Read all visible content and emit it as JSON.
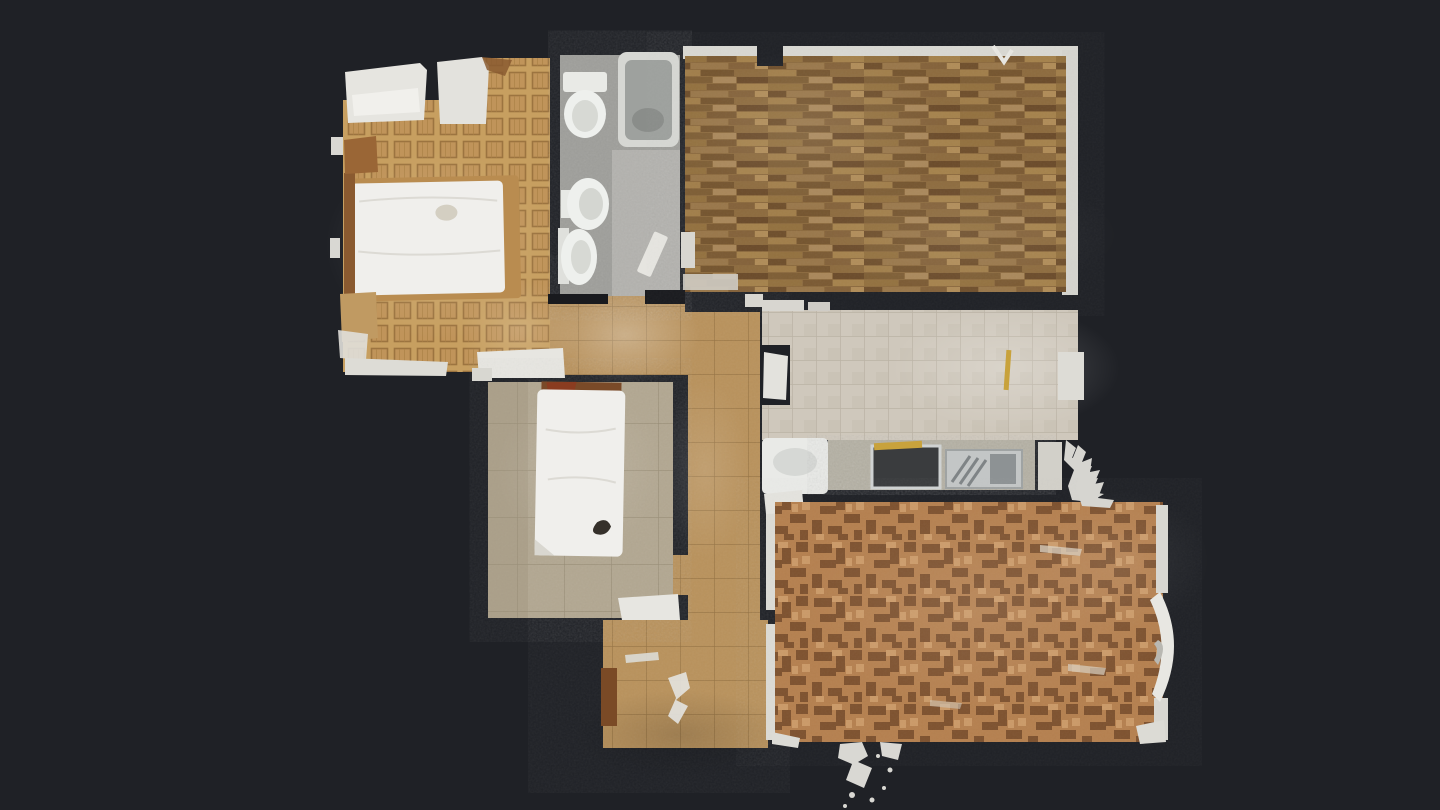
{
  "view": {
    "name": "top-down 3D dollhouse floor plan scan",
    "background_color": "#1f2126",
    "wall_gap_color": "#191a1e",
    "baseboard_color": "#e2e1dc",
    "mattress_color": "#f0efec",
    "artifact_color": "#d9d8d3"
  },
  "rooms": [
    {
      "id": "bedroom-1",
      "label": "double bedroom",
      "floor_type": "square oak parquet",
      "floor_color": "#c79f60",
      "grid_color": "#9c7440",
      "furniture": [
        "double-bed",
        "wardrobe",
        "nightstand",
        "headboard"
      ]
    },
    {
      "id": "bathroom",
      "label": "bathroom",
      "floor_type": "grey screed",
      "floor_color": "#9e9e9a",
      "fixtures": [
        "toilet",
        "bathtub",
        "bidet",
        "pedestal-sink",
        "door-leaf"
      ]
    },
    {
      "id": "bedroom-2",
      "label": "empty parquet room",
      "floor_type": "strip wood parquet",
      "floor_color": "#8c6a3e"
    },
    {
      "id": "kitchen",
      "label": "kitchen",
      "floor_type": "beige ceramic tile",
      "floor_color": "#cfc8bc",
      "counter_color": "#b4b0a3",
      "fixtures": [
        "washing-machine",
        "counter",
        "cooktop",
        "sink-drainer",
        "brass-rail"
      ]
    },
    {
      "id": "bedroom-3",
      "label": "single bedroom",
      "floor_type": "worn beige tile",
      "floor_color": "#b2a791",
      "furniture": [
        "single-bed",
        "door-leaf"
      ]
    },
    {
      "id": "living-room",
      "label": "living room",
      "floor_type": "mosaic parquet",
      "floor_color": "#b5804f",
      "mosaic_dark_color": "#7a4e2c",
      "mosaic_light_color": "#cf9f6c"
    },
    {
      "id": "hallway",
      "label": "hallway and entry",
      "floor_type": "terracotta tile",
      "floor_color": "#b9925c",
      "fixtures": [
        "entry-door"
      ]
    }
  ]
}
